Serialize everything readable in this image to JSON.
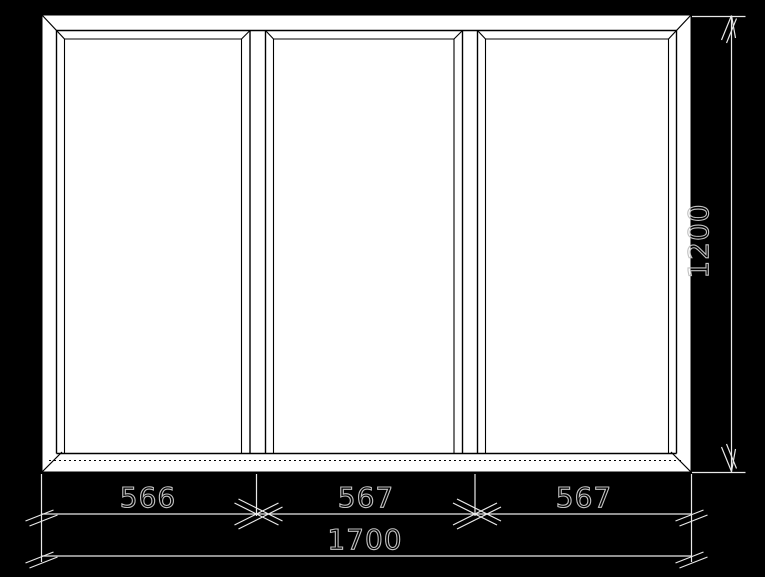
{
  "drawing": {
    "type": "window-elevation-technical-drawing",
    "window": {
      "panel_count": 3,
      "panels": [
        "fixed-glass",
        "fixed-glass",
        "fixed-glass"
      ]
    },
    "dimensions": {
      "panel_widths": [
        "566",
        "567",
        "567"
      ],
      "total_width": "1700",
      "height": "1200"
    },
    "colors": {
      "background": "#000000",
      "frame_fill": "#ffffff",
      "profile_line": "#000000",
      "dimension_line": "#e8e8e8",
      "dimension_text_outline": "#c2c2c2"
    }
  }
}
